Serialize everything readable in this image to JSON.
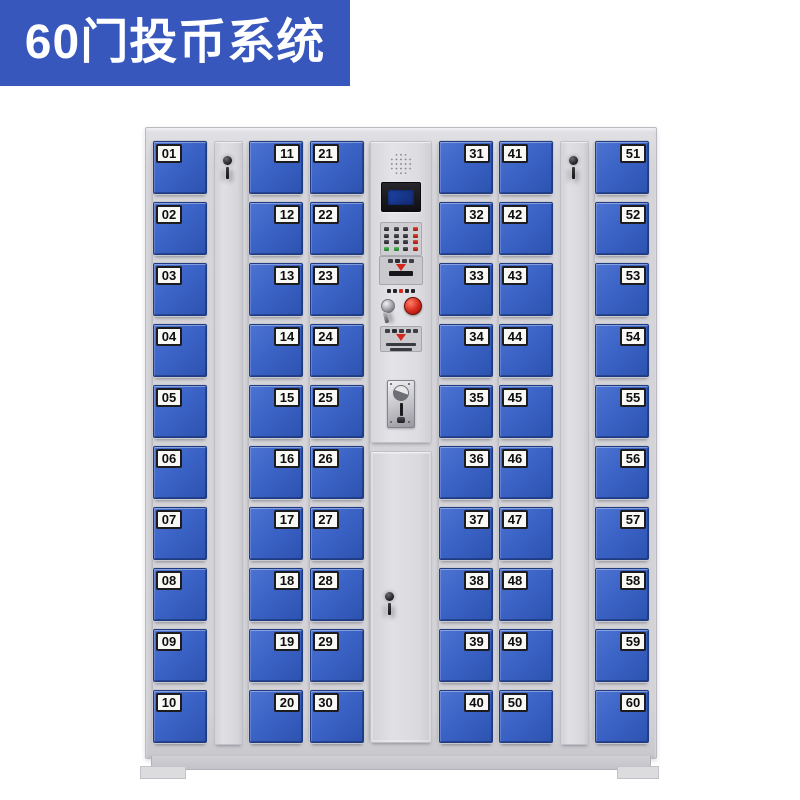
{
  "banner": {
    "title": "60门投币系统"
  },
  "colors": {
    "banner_bg": "#3757bd",
    "door_blue": "#3b63c6",
    "frame_gray": "#d6d6da",
    "accent_red": "#d3281c",
    "keypad_green": "#2f9e44",
    "screen_blue": "#16317d",
    "label_bg": "#f8f8f5",
    "label_text": "#0e0e10"
  },
  "cabinet": {
    "door_count": 60,
    "columns": [
      {
        "kind": "doors",
        "label_side": "left",
        "doors": [
          "01",
          "02",
          "03",
          "04",
          "05",
          "06",
          "07",
          "08",
          "09",
          "10"
        ]
      },
      {
        "kind": "narrow"
      },
      {
        "kind": "doors",
        "label_side": "right",
        "doors": [
          "11",
          "12",
          "13",
          "14",
          "15",
          "16",
          "17",
          "18",
          "19",
          "20"
        ]
      },
      {
        "kind": "doors",
        "label_side": "left",
        "doors": [
          "21",
          "22",
          "23",
          "24",
          "25",
          "26",
          "27",
          "28",
          "29",
          "30"
        ]
      },
      {
        "kind": "panel"
      },
      {
        "kind": "doors",
        "label_side": "right",
        "doors": [
          "31",
          "32",
          "33",
          "34",
          "35",
          "36",
          "37",
          "38",
          "39",
          "40"
        ]
      },
      {
        "kind": "doors",
        "label_side": "left",
        "doors": [
          "41",
          "42",
          "43",
          "44",
          "45",
          "46",
          "47",
          "48",
          "49",
          "50"
        ]
      },
      {
        "kind": "narrow"
      },
      {
        "kind": "doors",
        "label_side": "right",
        "doors": [
          "51",
          "52",
          "53",
          "54",
          "55",
          "56",
          "57",
          "58",
          "59",
          "60"
        ]
      }
    ]
  },
  "control_panel": {
    "components": [
      "speaker-grille",
      "lcd-display",
      "keypad",
      "card-reader-slot",
      "key-lock",
      "red-button",
      "ticket-slot",
      "coin-acceptor",
      "service-door"
    ]
  }
}
